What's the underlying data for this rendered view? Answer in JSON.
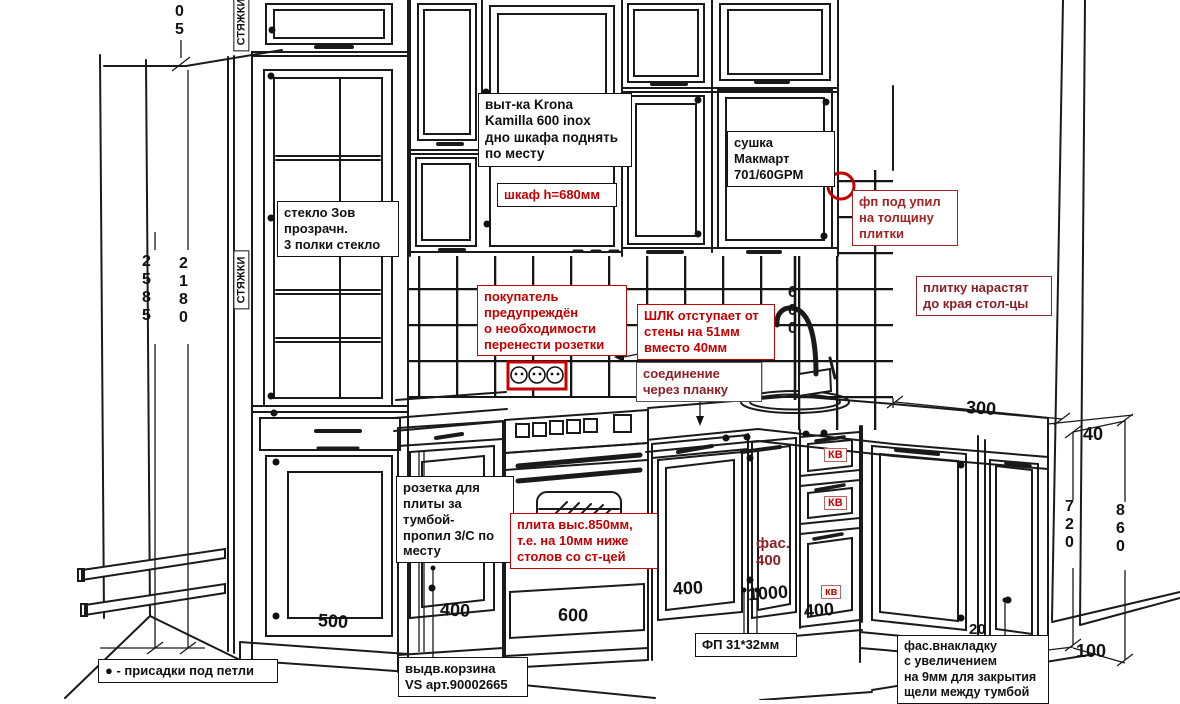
{
  "colors": {
    "ink": "#1a1a1a",
    "red": "#c40000",
    "dark_red": "#a52222",
    "maroon": "#8b2026",
    "bg": "#ffffff"
  },
  "notes": {
    "stretcher": "СТЯЖКИ",
    "glass": "стекло Зов\nпрозрачн.\n3 полки стекло",
    "hood": "выт-ка Krona\nKamilla 600 inox\nдно шкафа поднять\nпо месту",
    "hood_height": "шкаф h=680мм",
    "dryer": "сушка\nМакмарт\n701/60GPM",
    "fp_trim": "фп под упил\nна толщину\nплитки",
    "tile_extend": "плитку нарастят\nдо края стол-цы",
    "buyer": "покупатель\nпредупреждён\nо необходимости\nперенести розетки",
    "shlk": "ШЛК отступает от\nстены на 51мм\nвместо 40мм",
    "joint": "соединение\nчерез планку",
    "socket": "розетка для\nплиты за тумбой-\nпропил 3/С по\nместу",
    "stove": "плита выс.850мм,\nт.е. на 10мм ниже\nстолов со ст-цей",
    "basket": "выдв.корзина\nVS арт.90002665",
    "fp_profile": "ФП 31*32мм",
    "facade_overlay": "фас.внакладку\nс увеличением\nна 9мм для закрытия\nщели между тумбой",
    "hinge_legend": "● - присадки под петли",
    "facade_400": "фас.\n400",
    "kv1": "КВ",
    "kv2": "КВ",
    "kv3": "кв"
  },
  "dims": {
    "top_offset": "05",
    "total_left": "2585",
    "inner_left": "2180",
    "splash_height": "600",
    "counter_depth": "300",
    "gap_top": "40",
    "base_height": "720",
    "total_right": "860",
    "plinth_height": "100",
    "gap_corner": "20",
    "pantry": "500",
    "cab_left": "400",
    "stove": "600",
    "cab_right": "400",
    "corner": "1000",
    "drawers": "400"
  }
}
